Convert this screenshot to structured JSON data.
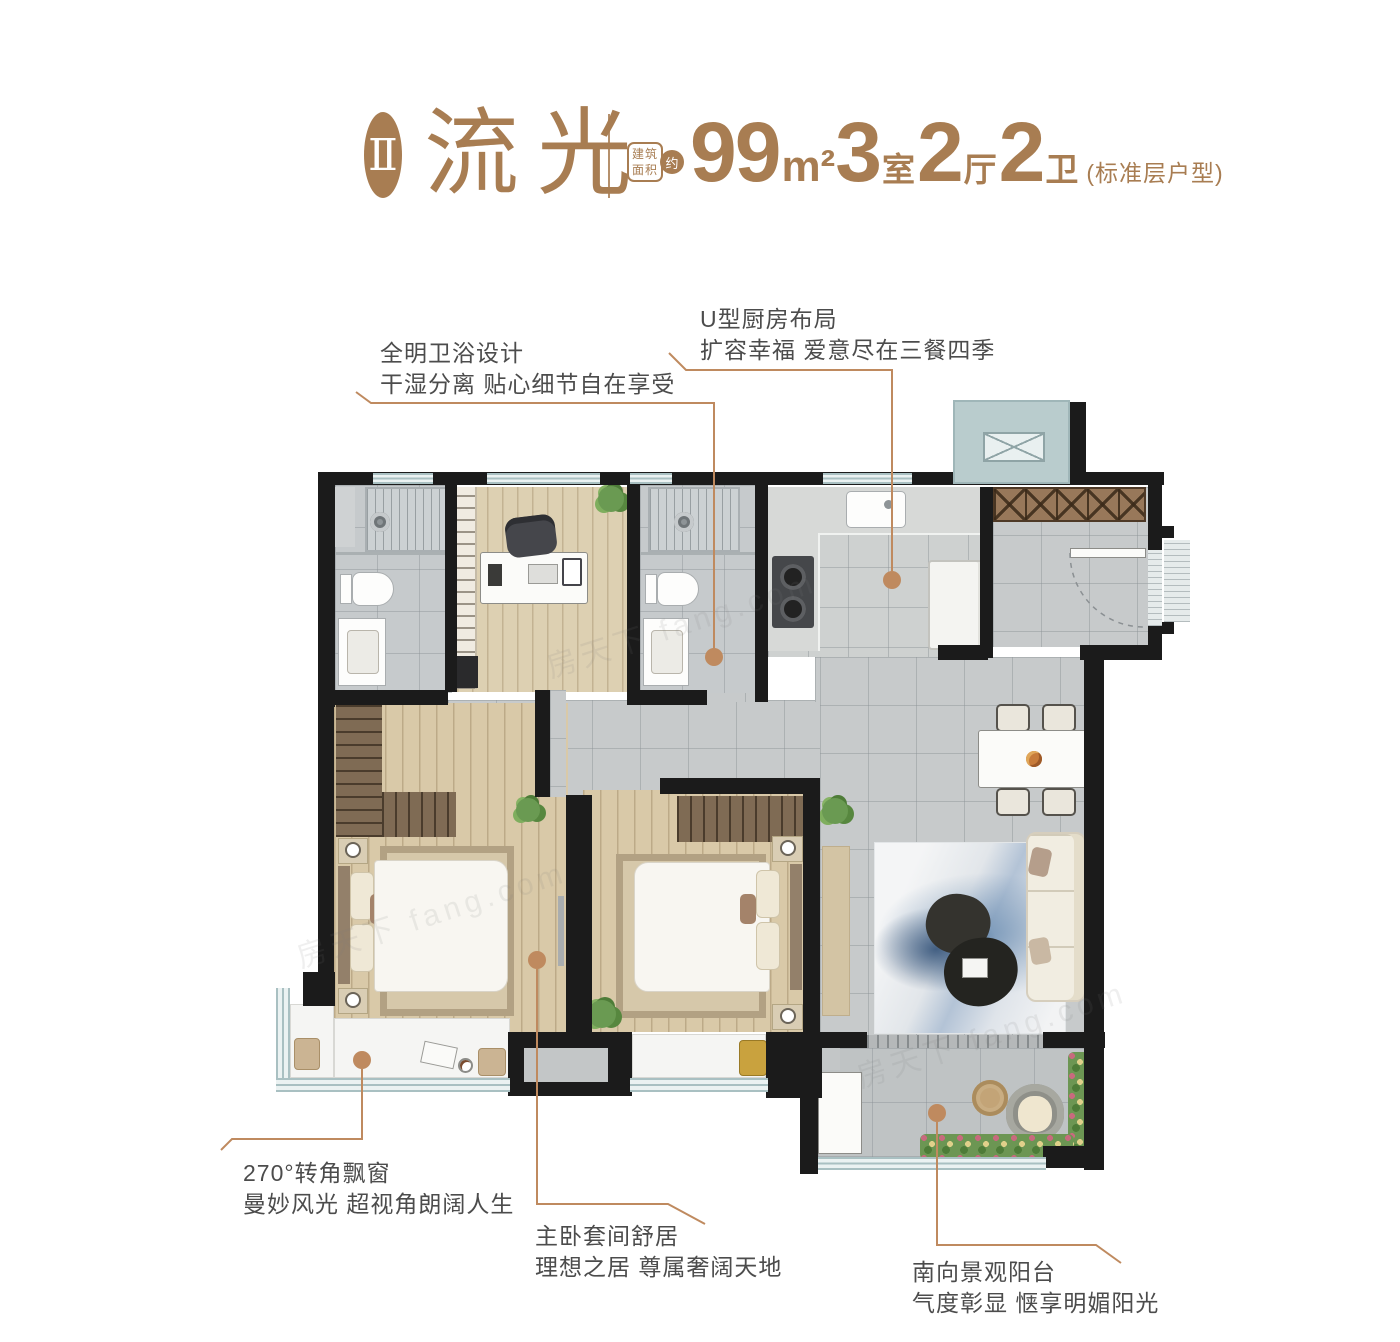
{
  "header": {
    "badge": "Ⅱ",
    "title": "流光",
    "area_label": [
      "建筑",
      "面积"
    ],
    "approx": "约",
    "area_value": "99",
    "area_unit": "m²",
    "stats": [
      {
        "value": "3",
        "unit": "室"
      },
      {
        "value": "2",
        "unit": "厅"
      },
      {
        "value": "2",
        "unit": "卫"
      }
    ],
    "note": "(标准层户型)"
  },
  "callouts": {
    "bathroom": {
      "line1": "全明卫浴设计",
      "line2": "干湿分离 贴心细节自在享受"
    },
    "kitchen": {
      "line1": "U型厨房布局",
      "line2": "扩容幸福 爱意尽在三餐四季"
    },
    "bay_window": {
      "line1": "270°转角飘窗",
      "line2": "曼妙风光 超视角朗阔人生"
    },
    "master_suite": {
      "line1": "主卧套间舒居",
      "line2": "理想之居 尊属奢阔天地"
    },
    "balcony": {
      "line1": "南向景观阳台",
      "line2": "气度彰显 惬享明媚阳光"
    }
  },
  "watermark": "房天下 fang.com",
  "colors": {
    "accent": "#A87D52",
    "callout_line": "#BF8A5F",
    "wall": "#1B1B1B",
    "window_frame": "#9FB6B8",
    "text": "#4C4C4C"
  }
}
